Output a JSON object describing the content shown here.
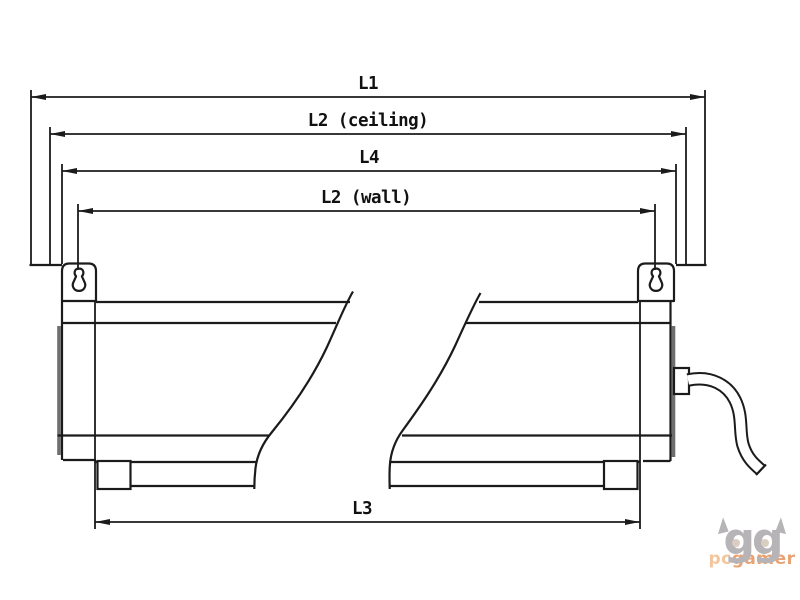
{
  "diagram": {
    "type": "technical-dimension-drawing",
    "subject": "linear luminaire side profile with mounting brackets",
    "line_color": "#1b1b1b",
    "background_color": "#ffffff",
    "dimensions": [
      {
        "label": "L1"
      },
      {
        "label": "L2 (ceiling)"
      },
      {
        "label": "L4"
      },
      {
        "label": "L2 (wall)"
      },
      {
        "label": "L3"
      }
    ]
  },
  "watermark": {
    "logo_text": "gg",
    "brand_prefix": "pc",
    "brand_suffix": "gamer",
    "logo_color": "#b7b4b7",
    "brand_prefix_color": "#f2c79e",
    "brand_suffix_color": "#e7a374"
  }
}
